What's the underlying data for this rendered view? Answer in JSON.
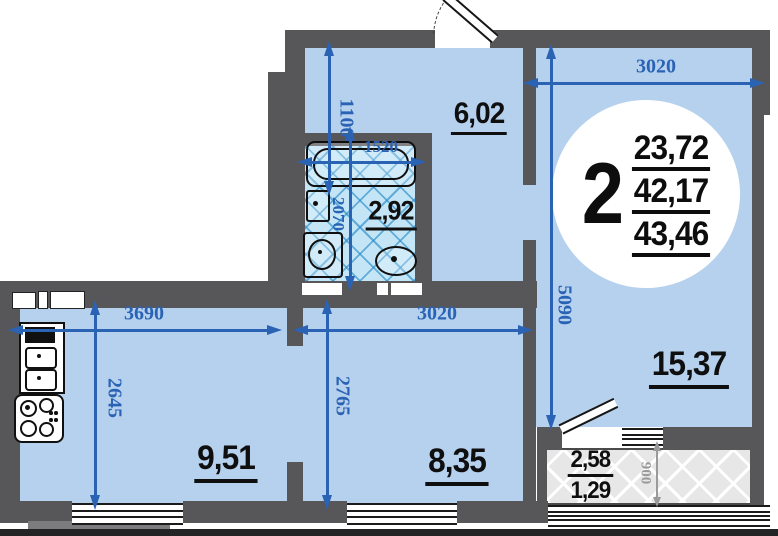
{
  "title": "2-room apartment floor plan",
  "badge": {
    "room_count": "2",
    "living_area": "23,72",
    "usable_area": "42,17",
    "total_area": "43,46"
  },
  "areas": {
    "hall": "6,02",
    "bathroom": "2,92",
    "living": "15,37",
    "kitchen": "9,51",
    "room": "8,35",
    "balcony_full": "2,58",
    "balcony_reduced": "1,29"
  },
  "dimensions": {
    "hall_depth": "1100",
    "bath_width": "1520",
    "bath_depth": "2070",
    "living_width": "3020",
    "living_depth": "5090",
    "kitchen_width": "3690",
    "kitchen_depth": "2645",
    "room_width": "3020",
    "room_depth": "2765",
    "balcony_depth": "900"
  },
  "colors": {
    "wall": "#57575a",
    "room_fill": "#b5d1ee",
    "bathroom_fill": "#c3e5f6",
    "dimension_blue": "#2a63b4",
    "balcony_dim_gray": "#9a9a9c",
    "label_black": "#0f0f0f"
  }
}
